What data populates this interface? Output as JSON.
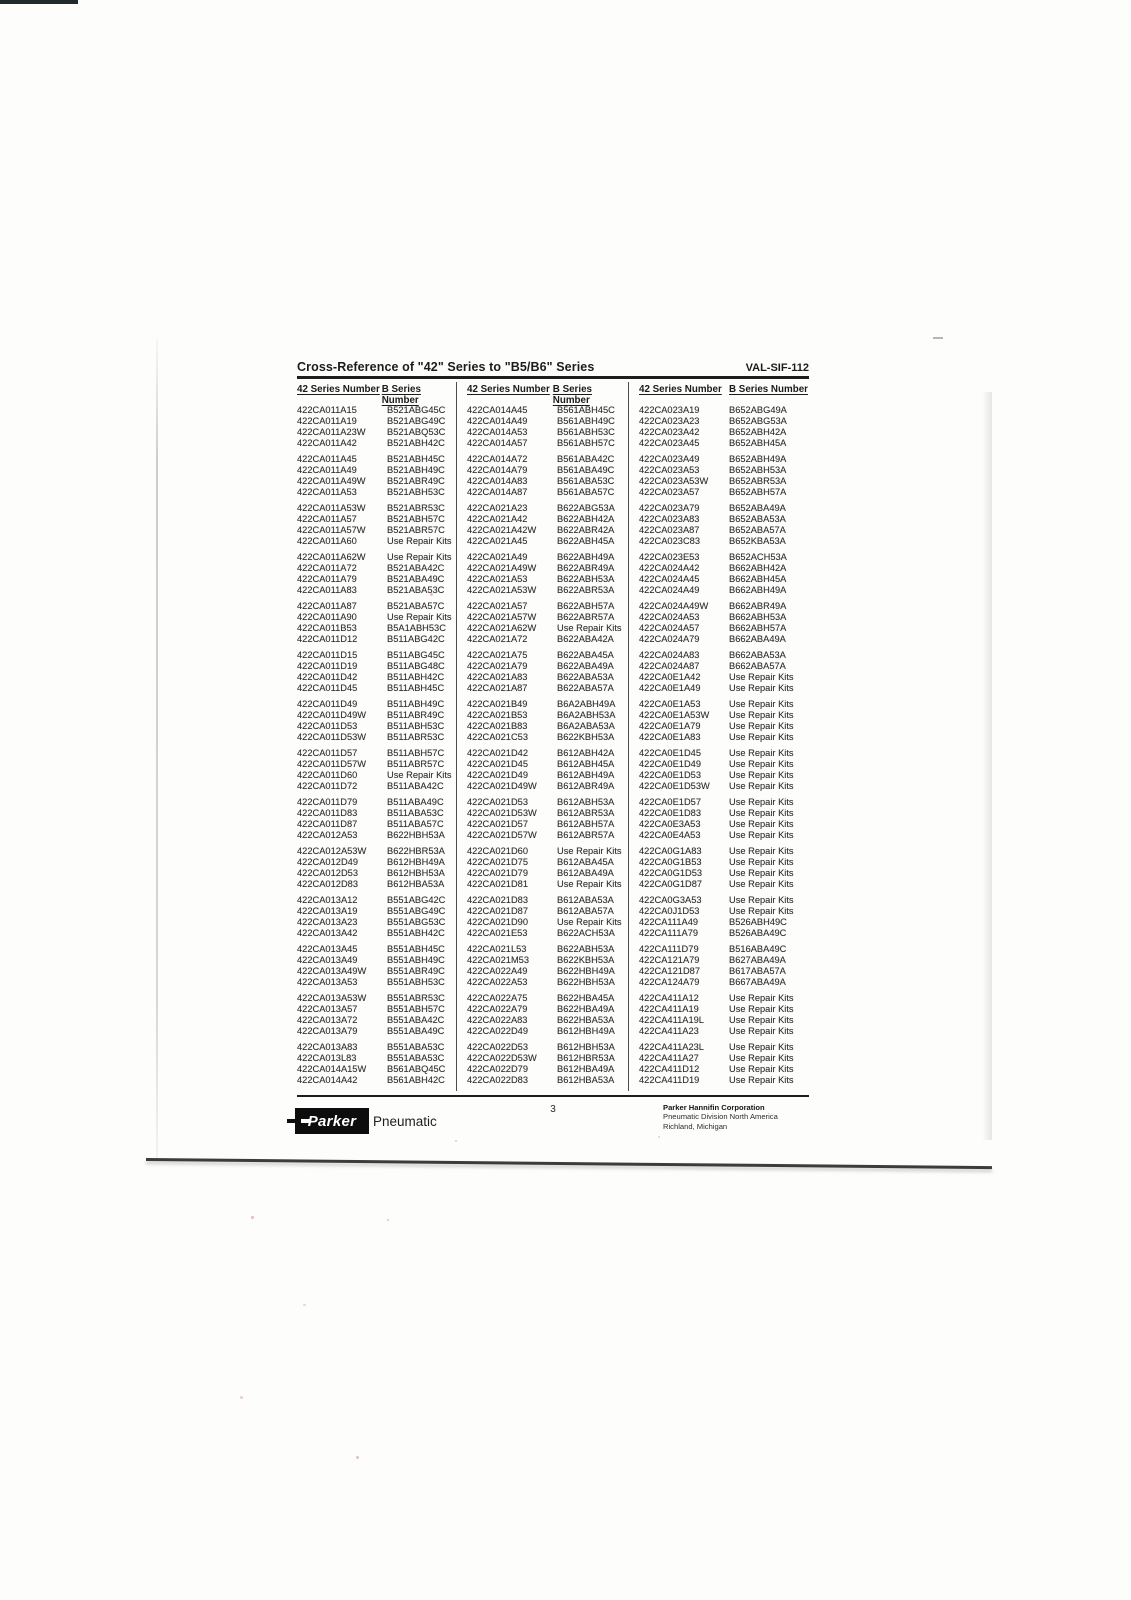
{
  "doc": {
    "title": "Cross-Reference of \"42\" Series to \"B5/B6\" Series",
    "doc_code": "VAL-SIF-112",
    "page_number": "3"
  },
  "footer": {
    "logo_text": "Parker",
    "logo_suffix": "Pneumatic",
    "company_name": "Parker Hannifin Corporation",
    "company_line2": "Pneumatic Division North America",
    "company_line3": "Richland, Michigan"
  },
  "table": {
    "header_42": "42 Series Number",
    "header_b": "B Series Number",
    "columns": [
      [
        [
          [
            "422CA011A15",
            "B521ABG45C"
          ],
          [
            "422CA011A19",
            "B521ABG49C"
          ],
          [
            "422CA011A23W",
            "B521ABQ53C"
          ],
          [
            "422CA011A42",
            "B521ABH42C"
          ]
        ],
        [
          [
            "422CA011A45",
            "B521ABH45C"
          ],
          [
            "422CA011A49",
            "B521ABH49C"
          ],
          [
            "422CA011A49W",
            "B521ABR49C"
          ],
          [
            "422CA011A53",
            "B521ABH53C"
          ]
        ],
        [
          [
            "422CA011A53W",
            "B521ABR53C"
          ],
          [
            "422CA011A57",
            "B521ABH57C"
          ],
          [
            "422CA011A57W",
            "B521ABR57C"
          ],
          [
            "422CA011A60",
            "Use Repair Kits"
          ]
        ],
        [
          [
            "422CA011A62W",
            "Use Repair Kits"
          ],
          [
            "422CA011A72",
            "B521ABA42C"
          ],
          [
            "422CA011A79",
            "B521ABA49C"
          ],
          [
            "422CA011A83",
            "B521ABA53C"
          ]
        ],
        [
          [
            "422CA011A87",
            "B521ABA57C"
          ],
          [
            "422CA011A90",
            "Use Repair Kits"
          ],
          [
            "422CA011B53",
            "B5A1ABH53C"
          ],
          [
            "422CA011D12",
            "B511ABG42C"
          ]
        ],
        [
          [
            "422CA011D15",
            "B511ABG45C"
          ],
          [
            "422CA011D19",
            "B511ABG48C"
          ],
          [
            "422CA011D42",
            "B511ABH42C"
          ],
          [
            "422CA011D45",
            "B511ABH45C"
          ]
        ],
        [
          [
            "422CA011D49",
            "B511ABH49C"
          ],
          [
            "422CA011D49W",
            "B511ABR49C"
          ],
          [
            "422CA011D53",
            "B511ABH53C"
          ],
          [
            "422CA011D53W",
            "B511ABR53C"
          ]
        ],
        [
          [
            "422CA011D57",
            "B511ABH57C"
          ],
          [
            "422CA011D57W",
            "B511ABR57C"
          ],
          [
            "422CA011D60",
            "Use Repair Kits"
          ],
          [
            "422CA011D72",
            "B511ABA42C"
          ]
        ],
        [
          [
            "422CA011D79",
            "B511ABA49C"
          ],
          [
            "422CA011D83",
            "B511ABA53C"
          ],
          [
            "422CA011D87",
            "B511ABA57C"
          ],
          [
            "422CA012A53",
            "B622HBH53A"
          ]
        ],
        [
          [
            "422CA012A53W",
            "B622HBR53A"
          ],
          [
            "422CA012D49",
            "B612HBH49A"
          ],
          [
            "422CA012D53",
            "B612HBH53A"
          ],
          [
            "422CA012D83",
            "B612HBA53A"
          ]
        ],
        [
          [
            "422CA013A12",
            "B551ABG42C"
          ],
          [
            "422CA013A19",
            "B551ABG49C"
          ],
          [
            "422CA013A23",
            "B551ABG53C"
          ],
          [
            "422CA013A42",
            "B551ABH42C"
          ]
        ],
        [
          [
            "422CA013A45",
            "B551ABH45C"
          ],
          [
            "422CA013A49",
            "B551ABH49C"
          ],
          [
            "422CA013A49W",
            "B551ABR49C"
          ],
          [
            "422CA013A53",
            "B551ABH53C"
          ]
        ],
        [
          [
            "422CA013A53W",
            "B551ABR53C"
          ],
          [
            "422CA013A57",
            "B551ABH57C"
          ],
          [
            "422CA013A72",
            "B551ABA42C"
          ],
          [
            "422CA013A79",
            "B551ABA49C"
          ]
        ],
        [
          [
            "422CA013A83",
            "B551ABA53C"
          ],
          [
            "422CA013L83",
            "B551ABA53C"
          ],
          [
            "422CA014A15W",
            "B561ABQ45C"
          ],
          [
            "422CA014A42",
            "B561ABH42C"
          ]
        ]
      ],
      [
        [
          [
            "422CA014A45",
            "B561ABH45C"
          ],
          [
            "422CA014A49",
            "B561ABH49C"
          ],
          [
            "422CA014A53",
            "B561ABH53C"
          ],
          [
            "422CA014A57",
            "B561ABH57C"
          ]
        ],
        [
          [
            "422CA014A72",
            "B561ABA42C"
          ],
          [
            "422CA014A79",
            "B561ABA49C"
          ],
          [
            "422CA014A83",
            "B561ABA53C"
          ],
          [
            "422CA014A87",
            "B561ABA57C"
          ]
        ],
        [
          [
            "422CA021A23",
            "B622ABG53A"
          ],
          [
            "422CA021A42",
            "B622ABH42A"
          ],
          [
            "422CA021A42W",
            "B622ABR42A"
          ],
          [
            "422CA021A45",
            "B622ABH45A"
          ]
        ],
        [
          [
            "422CA021A49",
            "B622ABH49A"
          ],
          [
            "422CA021A49W",
            "B622ABR49A"
          ],
          [
            "422CA021A53",
            "B622ABH53A"
          ],
          [
            "422CA021A53W",
            "B622ABR53A"
          ]
        ],
        [
          [
            "422CA021A57",
            "B622ABH57A"
          ],
          [
            "422CA021A57W",
            "B622ABR57A"
          ],
          [
            "422CA021A62W",
            "Use Repair Kits"
          ],
          [
            "422CA021A72",
            "B622ABA42A"
          ]
        ],
        [
          [
            "422CA021A75",
            "B622ABA45A"
          ],
          [
            "422CA021A79",
            "B622ABA49A"
          ],
          [
            "422CA021A83",
            "B622ABA53A"
          ],
          [
            "422CA021A87",
            "B622ABA57A"
          ]
        ],
        [
          [
            "422CA021B49",
            "B6A2ABH49A"
          ],
          [
            "422CA021B53",
            "B6A2ABH53A"
          ],
          [
            "422CA021B83",
            "B6A2ABA53A"
          ],
          [
            "422CA021C53",
            "B622KBH53A"
          ]
        ],
        [
          [
            "422CA021D42",
            "B612ABH42A"
          ],
          [
            "422CA021D45",
            "B612ABH45A"
          ],
          [
            "422CA021D49",
            "B612ABH49A"
          ],
          [
            "422CA021D49W",
            "B612ABR49A"
          ]
        ],
        [
          [
            "422CA021D53",
            "B612ABH53A"
          ],
          [
            "422CA021D53W",
            "B612ABR53A"
          ],
          [
            "422CA021D57",
            "B612ABH57A"
          ],
          [
            "422CA021D57W",
            "B612ABR57A"
          ]
        ],
        [
          [
            "422CA021D60",
            "Use Repair Kits"
          ],
          [
            "422CA021D75",
            "B612ABA45A"
          ],
          [
            "422CA021D79",
            "B612ABA49A"
          ],
          [
            "422CA021D81",
            "Use Repair Kits"
          ]
        ],
        [
          [
            "422CA021D83",
            "B612ABA53A"
          ],
          [
            "422CA021D87",
            "B612ABA57A"
          ],
          [
            "422CA021D90",
            "Use Repair Kits"
          ],
          [
            "422CA021E53",
            "B622ACH53A"
          ]
        ],
        [
          [
            "422CA021L53",
            "B622ABH53A"
          ],
          [
            "422CA021M53",
            "B622KBH53A"
          ],
          [
            "422CA022A49",
            "B622HBH49A"
          ],
          [
            "422CA022A53",
            "B622HBH53A"
          ]
        ],
        [
          [
            "422CA022A75",
            "B622HBA45A"
          ],
          [
            "422CA022A79",
            "B622HBA49A"
          ],
          [
            "422CA022A83",
            "B622HBA53A"
          ],
          [
            "422CA022D49",
            "B612HBH49A"
          ]
        ],
        [
          [
            "422CA022D53",
            "B612HBH53A"
          ],
          [
            "422CA022D53W",
            "B612HBR53A"
          ],
          [
            "422CA022D79",
            "B612HBA49A"
          ],
          [
            "422CA022D83",
            "B612HBA53A"
          ]
        ]
      ],
      [
        [
          [
            "422CA023A19",
            "B652ABG49A"
          ],
          [
            "422CA023A23",
            "B652ABG53A"
          ],
          [
            "422CA023A42",
            "B652ABH42A"
          ],
          [
            "422CA023A45",
            "B652ABH45A"
          ]
        ],
        [
          [
            "422CA023A49",
            "B652ABH49A"
          ],
          [
            "422CA023A53",
            "B652ABH53A"
          ],
          [
            "422CA023A53W",
            "B652ABR53A"
          ],
          [
            "422CA023A57",
            "B652ABH57A"
          ]
        ],
        [
          [
            "422CA023A79",
            "B652ABA49A"
          ],
          [
            "422CA023A83",
            "B652ABA53A"
          ],
          [
            "422CA023A87",
            "B652ABA57A"
          ],
          [
            "422CA023C83",
            "B652KBA53A"
          ]
        ],
        [
          [
            "422CA023E53",
            "B652ACH53A"
          ],
          [
            "422CA024A42",
            "B662ABH42A"
          ],
          [
            "422CA024A45",
            "B662ABH45A"
          ],
          [
            "422CA024A49",
            "B662ABH49A"
          ]
        ],
        [
          [
            "422CA024A49W",
            "B662ABR49A"
          ],
          [
            "422CA024A53",
            "B662ABH53A"
          ],
          [
            "422CA024A57",
            "B662ABH57A"
          ],
          [
            "422CA024A79",
            "B662ABA49A"
          ]
        ],
        [
          [
            "422CA024A83",
            "B662ABA53A"
          ],
          [
            "422CA024A87",
            "B662ABA57A"
          ],
          [
            "422CA0E1A42",
            "Use Repair Kits"
          ],
          [
            "422CA0E1A49",
            "Use Repair Kits"
          ]
        ],
        [
          [
            "422CA0E1A53",
            "Use Repair Kits"
          ],
          [
            "422CA0E1A53W",
            "Use Repair Kits"
          ],
          [
            "422CA0E1A79",
            "Use Repair Kits"
          ],
          [
            "422CA0E1A83",
            "Use Repair Kits"
          ]
        ],
        [
          [
            "422CA0E1D45",
            "Use Repair Kits"
          ],
          [
            "422CA0E1D49",
            "Use Repair Kits"
          ],
          [
            "422CA0E1D53",
            "Use Repair Kits"
          ],
          [
            "422CA0E1D53W",
            "Use Repair Kits"
          ]
        ],
        [
          [
            "422CA0E1D57",
            "Use Repair Kits"
          ],
          [
            "422CA0E1D83",
            "Use Repair Kits"
          ],
          [
            "422CA0E3A53",
            "Use Repair Kits"
          ],
          [
            "422CA0E4A53",
            "Use Repair Kits"
          ]
        ],
        [
          [
            "422CA0G1A83",
            "Use Repair Kits"
          ],
          [
            "422CA0G1B53",
            "Use Repair Kits"
          ],
          [
            "422CA0G1D53",
            "Use Repair Kits"
          ],
          [
            "422CA0G1D87",
            "Use Repair Kits"
          ]
        ],
        [
          [
            "422CA0G3A53",
            "Use Repair Kits"
          ],
          [
            "422CA0J1D53",
            "Use Repair Kits"
          ],
          [
            "422CA111A49",
            "B526ABH49C"
          ],
          [
            "422CA111A79",
            "B526ABA49C"
          ]
        ],
        [
          [
            "422CA111D79",
            "B516ABA49C"
          ],
          [
            "422CA121A79",
            "B627ABA49A"
          ],
          [
            "422CA121D87",
            "B617ABA57A"
          ],
          [
            "422CA124A79",
            "B667ABA49A"
          ]
        ],
        [
          [
            "422CA411A12",
            "Use Repair Kits"
          ],
          [
            "422CA411A19",
            "Use Repair Kits"
          ],
          [
            "422CA411A19L",
            "Use Repair Kits"
          ],
          [
            "422CA411A23",
            "Use Repair Kits"
          ]
        ],
        [
          [
            "422CA411A23L",
            "Use Repair Kits"
          ],
          [
            "422CA411A27",
            "Use Repair Kits"
          ],
          [
            "422CA411D12",
            "Use Repair Kits"
          ],
          [
            "422CA411D19",
            "Use Repair Kits"
          ]
        ]
      ]
    ]
  }
}
